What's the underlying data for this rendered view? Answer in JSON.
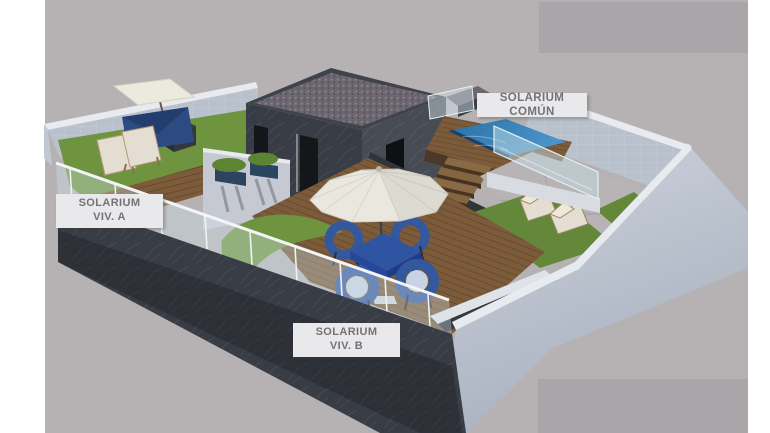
{
  "title": "Rooftop solarium 3D render",
  "labels": {
    "solarium_comun": {
      "text": "SOLARIUM COMÚN"
    },
    "solarium_viv_a": {
      "line1": "SOLARIUM",
      "line2": "VIV. A"
    },
    "solarium_viv_b": {
      "line1": "SOLARIUM",
      "line2": "VIV. B"
    }
  },
  "colors": {
    "page": "#ffffff",
    "canvas": "#b6b2b4",
    "panel": "#a9a5a8",
    "wall_light": "#b9c1cd",
    "wall_cap": "#e7eaef",
    "wall_outer": "#c6ccd8",
    "charcoal": "#383c44",
    "charcoal_dark": "#24272c",
    "block_front": "#383c44",
    "block_right": "#474b54",
    "roof_rim": "#3f434b",
    "gravel": "#6d6772",
    "wood": "#7c5b3a",
    "wood_dark": "#4b3828",
    "grass": "#6f9440",
    "grass_dim": "#64883a",
    "pool": "#3380b8",
    "pool_deep": "#1d3f63",
    "pavement": "#b8b3b5",
    "umbrella": "#eae7df",
    "parasol": "#ece9dd",
    "sail_blue": "#2c4b82",
    "furniture_blue": "#34589e",
    "table_blue": "#2f54a2",
    "cushion": "#c7d2e2",
    "planter": "#2b4460",
    "plant_green": "#5d8433",
    "lounger_fabric": "#e3ddd2",
    "lounger_wood": "#b59a74",
    "glass_tint": "#cfe2e8",
    "label_bg": "#e9e8ea",
    "label_text": "#737376",
    "door_dark": "#14161a"
  }
}
